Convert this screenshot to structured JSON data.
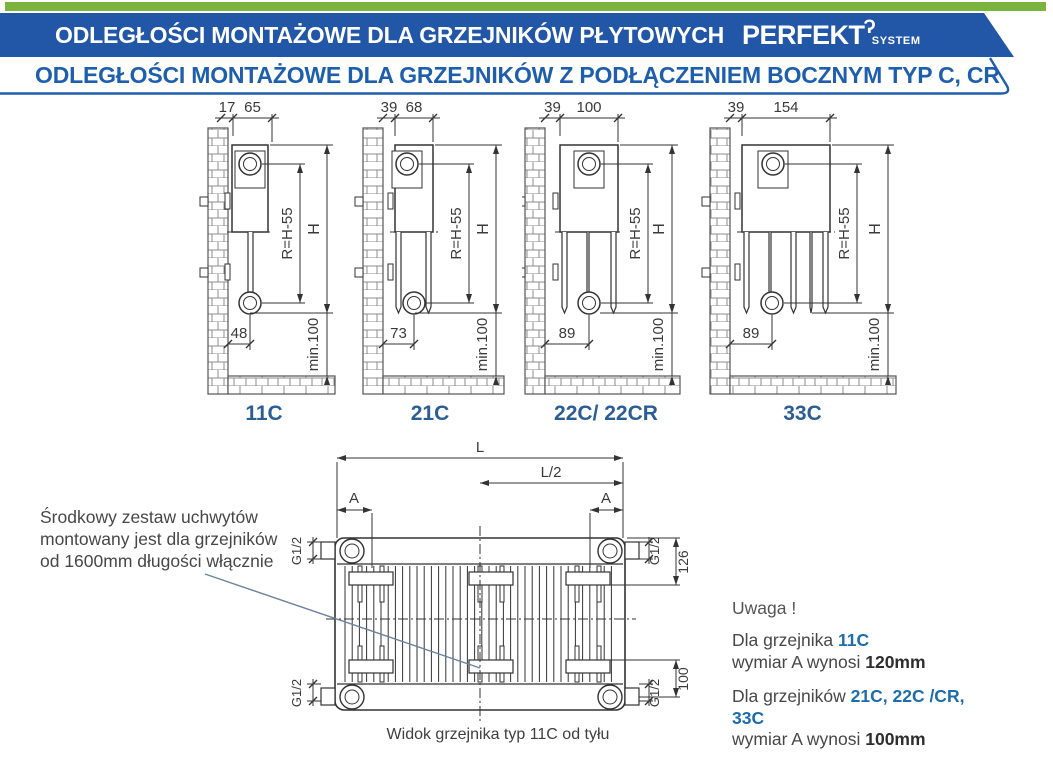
{
  "header": {
    "title": "ODLEGŁOŚCI  MONTAŻOWE  DLA GRZEJNIKÓW  PŁYTOWYCH",
    "logo": {
      "brand": "PERFEKT",
      "sub": "SYSTEM"
    },
    "subtitle": "ODLEGŁOŚCI MONTAŻOWE DLA GRZEJNIKÓW Z PODŁĄCZENIEM BOCZNYM TYP C, CR"
  },
  "diagrams": [
    {
      "label": "11C",
      "dim_wall": "17",
      "dim_depth": "65",
      "dim_bottom": "48",
      "dim_radius": "R=H-55",
      "dim_height": "H",
      "dim_min": "min.100"
    },
    {
      "label": "21C",
      "dim_wall": "39",
      "dim_depth": "68",
      "dim_bottom": "73",
      "dim_radius": "R=H-55",
      "dim_height": "H",
      "dim_min": "min.100"
    },
    {
      "label": "22C/ 22CR",
      "dim_wall": "39",
      "dim_depth": "100",
      "dim_bottom": "89",
      "dim_radius": "R=H-55",
      "dim_height": "H",
      "dim_min": "min.100"
    },
    {
      "label": "33C",
      "dim_wall": "39",
      "dim_depth": "154",
      "dim_bottom": "89",
      "dim_radius": "R=H-55",
      "dim_height": "H",
      "dim_min": "min.100"
    }
  ],
  "rear_view": {
    "dim_length": "L",
    "dim_half_length": "L/2",
    "dim_a": "A",
    "dim_thread": "G1/2",
    "dim_bracket_top": "126",
    "dim_bracket_bottom": "100",
    "caption": "Widok grzejnika typ 11C od tyłu"
  },
  "notes": {
    "bracket_note": [
      "Środkowy zestaw uchwytów",
      "montowany jest dla grzejników",
      "od 1600mm długości włącznie"
    ],
    "warning_title": "Uwaga !",
    "note1": {
      "prefix": "Dla grzejnika ",
      "types": "11C",
      "line2_prefix": "wymiar A wynosi ",
      "value": "120mm"
    },
    "note2": {
      "prefix": "Dla grzejników ",
      "types": "21C, 22C /CR, 33C",
      "line2_prefix": "wymiar A wynosi ",
      "value": "100mm"
    }
  },
  "colors": {
    "accent_green": "#7ab43e",
    "header_blue": "#2157a6",
    "accent_blue": "#1d5fad",
    "type_label_blue": "#2b5e95",
    "drawing_line": "#333333"
  }
}
